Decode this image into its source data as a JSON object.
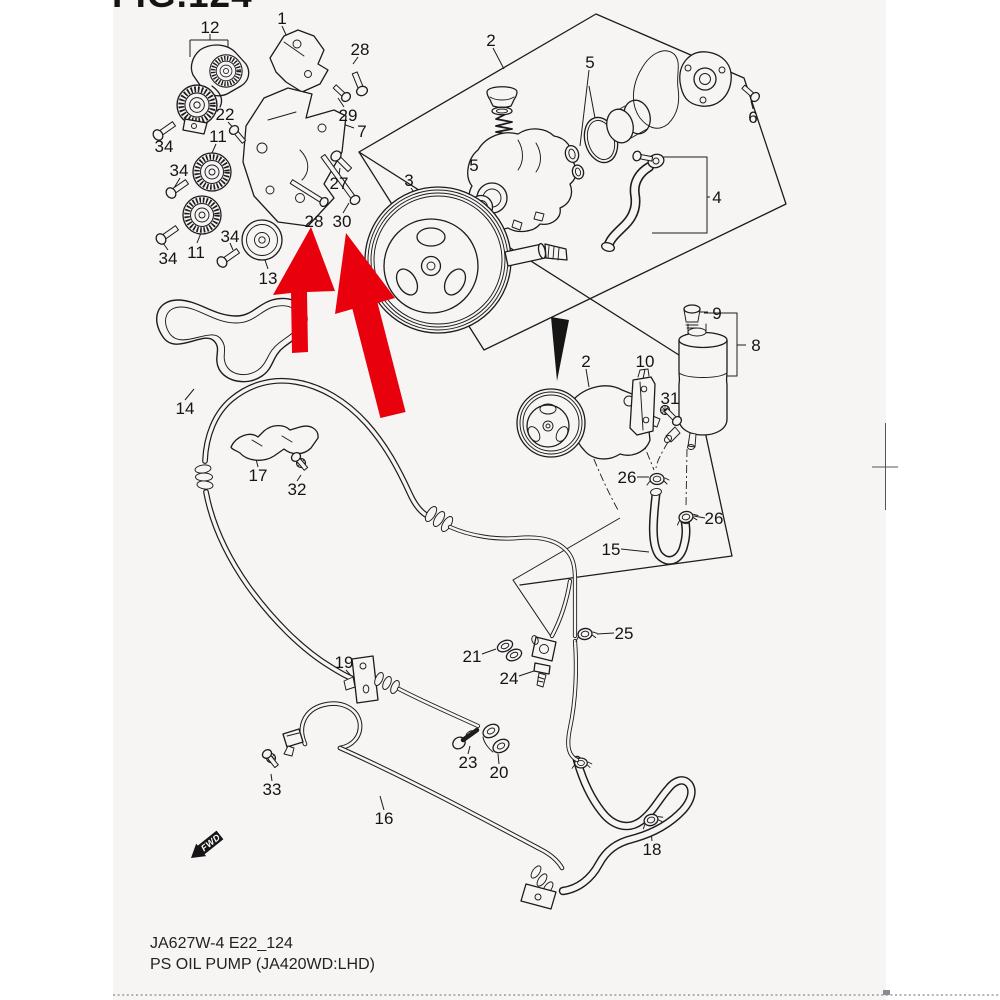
{
  "figure_title": "FIG.124",
  "footer": {
    "code_line": "JA627W-4 E22_124",
    "title_line": "PS OIL PUMP (JA420WD:LHD)"
  },
  "fwd_marker_label": "FWD",
  "colors": {
    "highlight_red": "#e8000d",
    "line": "#1c1c1c",
    "page_background": "#f7f4f4",
    "black_marker": "#151515"
  },
  "part_labels": [
    {
      "n": "12",
      "x": 210,
      "y": 27
    },
    {
      "n": "1",
      "x": 282,
      "y": 18
    },
    {
      "n": "28",
      "x": 360,
      "y": 49
    },
    {
      "n": "29",
      "x": 348,
      "y": 115
    },
    {
      "n": "7",
      "x": 362,
      "y": 131
    },
    {
      "n": "22",
      "x": 225,
      "y": 114
    },
    {
      "n": "11",
      "x": 218,
      "y": 136
    },
    {
      "n": "34",
      "x": 164,
      "y": 146
    },
    {
      "n": "34",
      "x": 179,
      "y": 170
    },
    {
      "n": "11",
      "x": 196,
      "y": 252
    },
    {
      "n": "34",
      "x": 168,
      "y": 258
    },
    {
      "n": "34",
      "x": 230,
      "y": 236
    },
    {
      "n": "13",
      "x": 268,
      "y": 278
    },
    {
      "n": "27",
      "x": 339,
      "y": 183
    },
    {
      "n": "28",
      "x": 314,
      "y": 221
    },
    {
      "n": "30",
      "x": 342,
      "y": 221
    },
    {
      "n": "14",
      "x": 185,
      "y": 408
    },
    {
      "n": "3",
      "x": 409,
      "y": 180
    },
    {
      "n": "5",
      "x": 474,
      "y": 165
    },
    {
      "n": "5",
      "x": 590,
      "y": 62
    },
    {
      "n": "2",
      "x": 491,
      "y": 40
    },
    {
      "n": "6",
      "x": 753,
      "y": 117
    },
    {
      "n": "4",
      "x": 717,
      "y": 197
    },
    {
      "n": "2",
      "x": 586,
      "y": 361
    },
    {
      "n": "9",
      "x": 717,
      "y": 313
    },
    {
      "n": "8",
      "x": 756,
      "y": 345
    },
    {
      "n": "10",
      "x": 645,
      "y": 361
    },
    {
      "n": "31",
      "x": 670,
      "y": 398
    },
    {
      "n": "26",
      "x": 627,
      "y": 477
    },
    {
      "n": "26",
      "x": 714,
      "y": 518
    },
    {
      "n": "15",
      "x": 611,
      "y": 549
    },
    {
      "n": "17",
      "x": 258,
      "y": 475
    },
    {
      "n": "32",
      "x": 297,
      "y": 489
    },
    {
      "n": "19",
      "x": 344,
      "y": 662
    },
    {
      "n": "21",
      "x": 472,
      "y": 656
    },
    {
      "n": "24",
      "x": 509,
      "y": 678
    },
    {
      "n": "25",
      "x": 624,
      "y": 633
    },
    {
      "n": "23",
      "x": 468,
      "y": 762
    },
    {
      "n": "20",
      "x": 499,
      "y": 772
    },
    {
      "n": "33",
      "x": 272,
      "y": 789
    },
    {
      "n": "16",
      "x": 384,
      "y": 818
    },
    {
      "n": "18",
      "x": 652,
      "y": 849
    }
  ]
}
